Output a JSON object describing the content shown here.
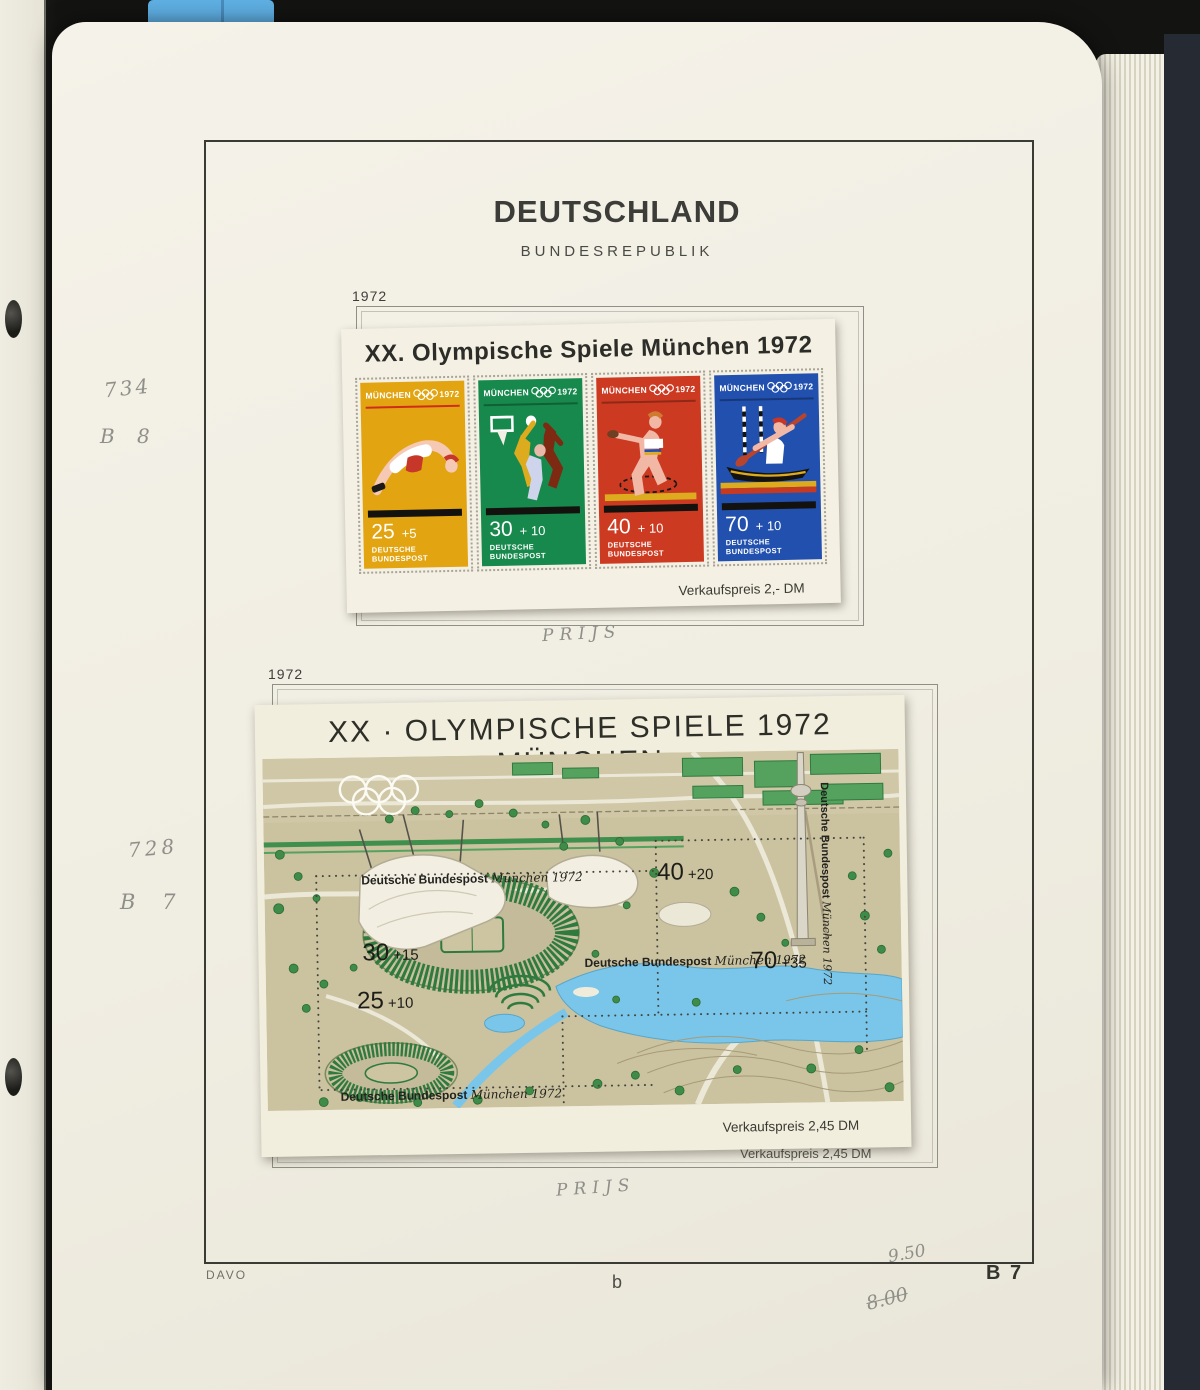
{
  "palette": {
    "tab_blue": "#5fb0e4"
  },
  "header": {
    "country": "DEUTSCHLAND",
    "subtitle": "BUNDESREPUBLIK"
  },
  "block1": {
    "year_label": "1972",
    "pencil_catalog": "734",
    "pencil_block": "B 8",
    "pencil_note": "PRIJS",
    "sheet": {
      "title": "XX. Olympische Spiele München 1972",
      "price_note": "Verkaufspreis  2,- DM",
      "stamps": [
        {
          "city": "MÜNCHEN",
          "year": "1972",
          "value": "25",
          "surcharge": "+5",
          "post": "DEUTSCHE BUNDESPOST",
          "bg": "#e2a411",
          "sport": "high-jump"
        },
        {
          "city": "MÜNCHEN",
          "year": "1972",
          "value": "30",
          "surcharge": "+ 10",
          "post": "DEUTSCHE BUNDESPOST",
          "bg": "#17894d",
          "sport": "basketball"
        },
        {
          "city": "MÜNCHEN",
          "year": "1972",
          "value": "40",
          "surcharge": "+ 10",
          "post": "DEUTSCHE BUNDESPOST",
          "bg": "#cd3a22",
          "sport": "discus"
        },
        {
          "city": "MÜNCHEN",
          "year": "1972",
          "value": "70",
          "surcharge": "+ 10",
          "post": "DEUTSCHE BUNDESPOST",
          "bg": "#2150ae",
          "sport": "canoe-slalom"
        }
      ]
    }
  },
  "block2": {
    "year_label": "1972",
    "pencil_catalog": "728",
    "pencil_block": "B 7",
    "pencil_note": "PRIJS",
    "sheet": {
      "title": "XX · OLYMPISCHE SPIELE 1972 MÜNCHEN",
      "price_note": "Verkaufspreis  2,45 DM",
      "printed_price_note": "Verkaufspreis  2,45 DM",
      "inscription": "Deutsche Bundespost",
      "inscription_city": "München 1972",
      "stamps": [
        {
          "value": "30",
          "surcharge": "+15"
        },
        {
          "value": "25",
          "surcharge": "+10"
        },
        {
          "value": "40",
          "surcharge": "+20"
        },
        {
          "value": "70",
          "surcharge": "+35"
        }
      ]
    }
  },
  "footer": {
    "publisher": "DAVO",
    "page_letter": "b",
    "page_code": "B 7",
    "pencil_price": "9.50",
    "pencil_price_old": "8.00"
  }
}
